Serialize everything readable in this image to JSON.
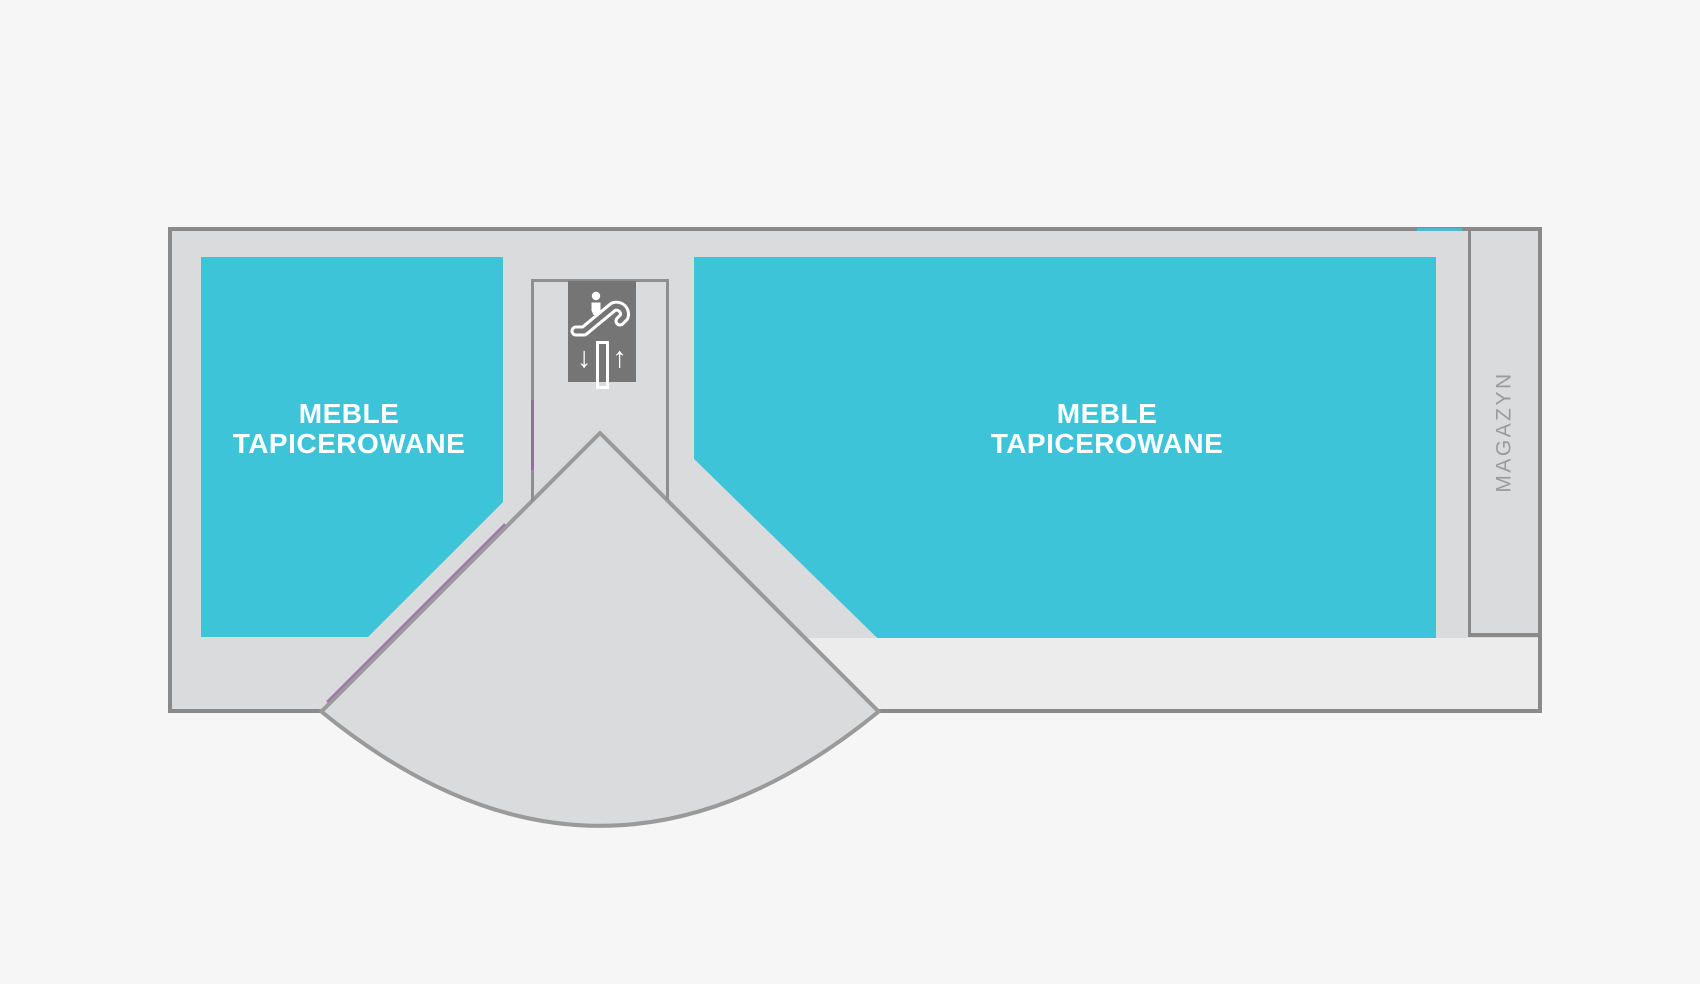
{
  "floor_plan": {
    "zones": [
      {
        "name": "meble-tapicerowane-left",
        "lines": [
          "MEBLE",
          "TAPICEROWANE"
        ]
      },
      {
        "name": "meble-tapicerowane-right",
        "lines": [
          "MEBLE",
          "TAPICEROWANE"
        ]
      }
    ],
    "storage_label": "MAGAZYN",
    "escalator": {
      "down": "↓",
      "up": "↑"
    },
    "colors": {
      "zone": "#3dc4d9",
      "floor": "#dadbdc",
      "corridor": "#ececed",
      "wall": "#8a8a8a",
      "enclosure_wall": "#8f8f8f",
      "accent": "#9c68a6",
      "sign_background": "#757575",
      "storage_text": "#9b9b9b",
      "background": "#f6f6f7",
      "label_text": "#ffffff"
    }
  }
}
